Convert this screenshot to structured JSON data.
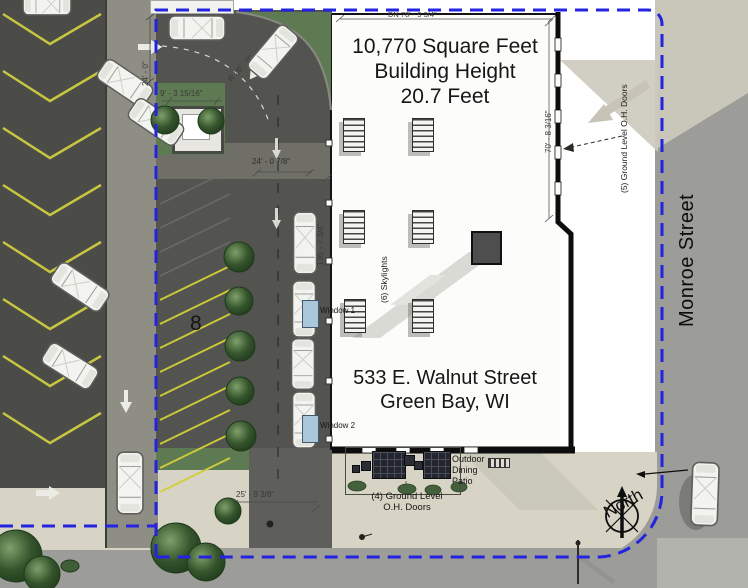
{
  "building": {
    "title_lines": [
      "10,770 Square Feet",
      "Building Height",
      "20.7 Feet"
    ],
    "address_lines": [
      "533 E. Walnut Street",
      "Green Bay, WI"
    ],
    "skylights_label": "(6) Skylights",
    "window1": "Window 1",
    "window2": "Window 2"
  },
  "dimensions": {
    "north_wall": "DN 78' - 9 3/4\"",
    "entry_drive_width": "24' - 0\"",
    "curb_radius": "R 26' - 0\"",
    "enclosure_width": "9' - 3 15/16\"",
    "aisle_width": "24' - 0 7/8\"",
    "west_wall_length": "136' - 7 3/4\"",
    "south_drive_width": "25' - 9 3/8\"",
    "east_wall_length": "70' - 8 3/16\""
  },
  "streets": {
    "east": "Monroe Street"
  },
  "compass": {
    "label": "North"
  },
  "parking": {
    "stall_count": "8"
  },
  "doors": {
    "east_label": "(5) Ground Level O.H. Doors",
    "south_label_lines": [
      "(4) Ground Level",
      "O.H. Doors"
    ]
  },
  "patio": {
    "label_lines": [
      "Outdoor",
      "Dining",
      "Patio"
    ]
  },
  "colors": {
    "boundary_blue": "#2424e0",
    "asphalt": "#4b4b48",
    "drive_lane": "#8f8e85",
    "sidewalk": "#d7d3c5",
    "grass": "#5e7a52",
    "stripe_yellow": "#d4d440",
    "street_gray": "#9c9c99",
    "building_fill": "#fcfcfa"
  }
}
